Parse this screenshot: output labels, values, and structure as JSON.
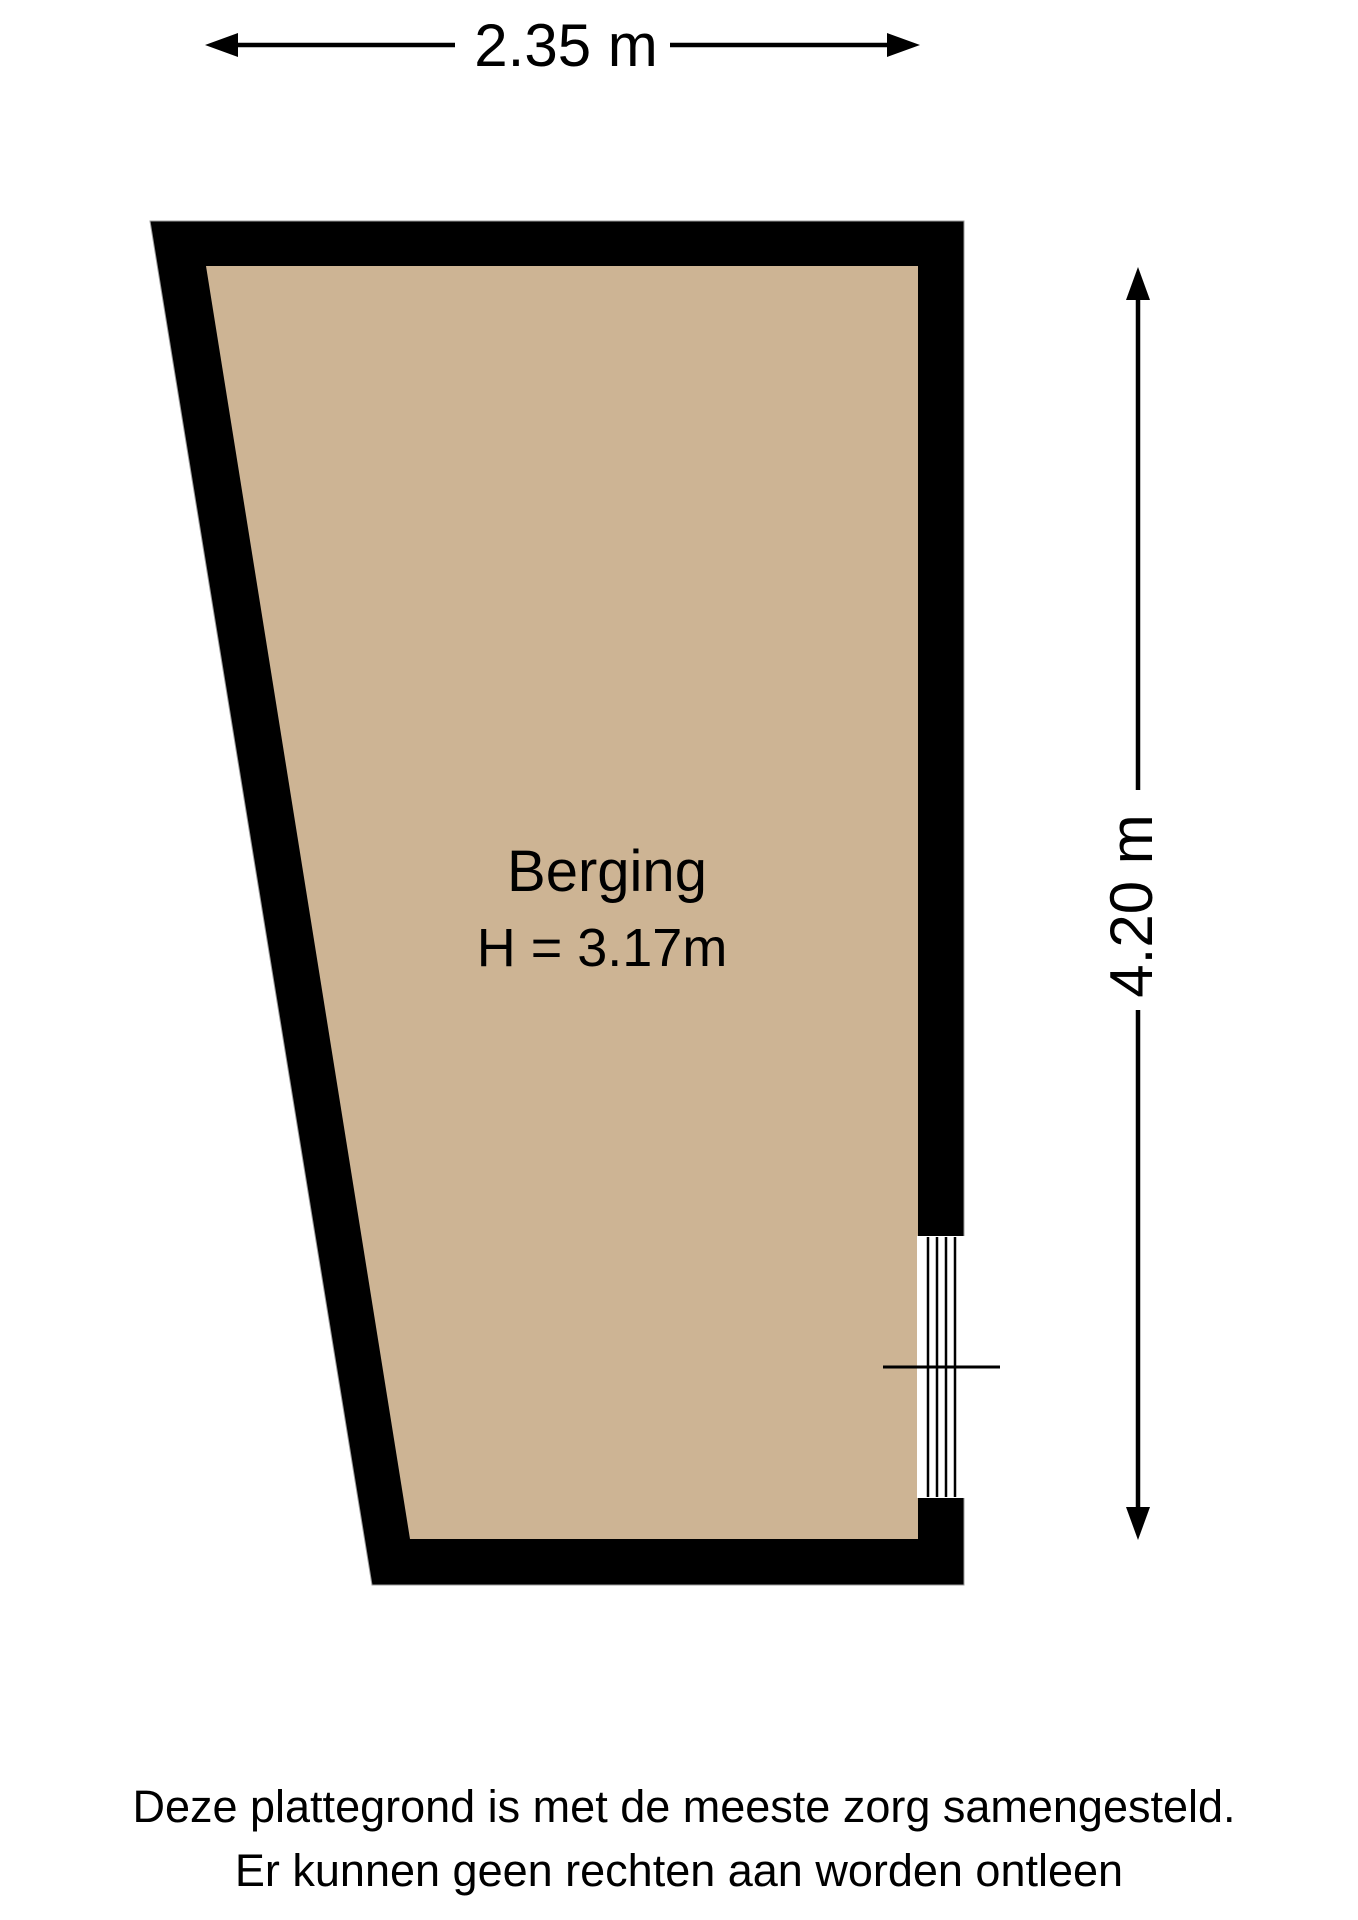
{
  "plan": {
    "room": {
      "name": "Berging",
      "ceiling_height": "H = 3.17m"
    },
    "dimensions": {
      "width": "2.35 m",
      "height": "4.20 m"
    },
    "footer": {
      "line1": "Deze plattegrond is met de meeste zorg samengesteld.",
      "line2": "Er kunnen geen rechten aan worden ontleen"
    },
    "colors": {
      "wall": "#000000",
      "floor": "#cdb494",
      "background": "#ffffff",
      "line": "#000000"
    }
  }
}
